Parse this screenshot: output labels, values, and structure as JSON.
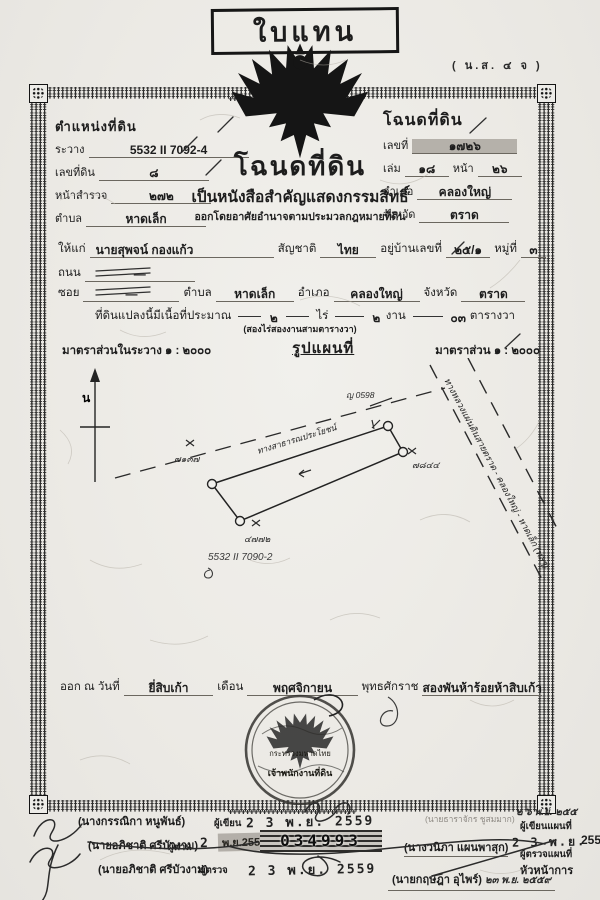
{
  "decor": {
    "motif": "‡"
  },
  "top": {
    "replacement": "ใบแทน",
    "form_code": "( น.ส. ๔ จ )"
  },
  "pos": {
    "title": "ตำแหน่งที่ดิน",
    "rawang_label": "ระวาง",
    "rawang": "5532 II 7092-4",
    "parcel_label": "เลขที่ดิน",
    "parcel": "๘",
    "survey_label": "หน้าสำรวจ",
    "survey": "๒๗๒",
    "tambon_label": "ตำบล",
    "tambon": "หาดเล็ก"
  },
  "deed": {
    "title": "โฉนดที่ดิน",
    "no_label": "เลขที่",
    "no": "๑๗๒๖",
    "book_label": "เล่ม",
    "book": "๑๘",
    "page_label": "หน้า",
    "page": "๒๖",
    "amphoe_label": "อำเภอ",
    "amphoe": "คลองใหญ่",
    "province_label": "จังหวัด",
    "province": "ตราด"
  },
  "title": {
    "main": "โฉนดที่ดิน",
    "sub": "เป็นหนังสือสำคัญแสดงกรรมสิทธิ์",
    "note": "ออกโดยอาศัยอำนาจตามประมวลกฎหมายที่ดิน"
  },
  "grantee": {
    "to_label": "ให้แก่",
    "name": "นายสุพจน์ กองแก้ว",
    "nationality_label": "สัญชาติ",
    "nationality": "ไทย",
    "address_label": "อยู่บ้านเลขที่",
    "address": "๒๕/๑",
    "moo_label": "หมู่ที่",
    "moo": "๓",
    "road_label": "ถนน",
    "road": "—",
    "soi_label": "ซอย",
    "soi": "—",
    "tambon_label": "ตำบล",
    "tambon": "หาดเล็ก",
    "amphoe_label": "อำเภอ",
    "amphoe": "คลองใหญ่",
    "province_label": "จังหวัด",
    "province": "ตราด"
  },
  "area": {
    "prefix": "ที่ดินแปลงนี้มีเนื้อที่ประมาณ",
    "rai": "๒",
    "rai_label": "ไร่",
    "ngan": "๒",
    "ngan_label": "งาน",
    "wa": "๐๓",
    "wa_label": "ตารางวา",
    "in_words": "(สองไร่สองงานสามตารางวา)"
  },
  "scale": {
    "left": "มาตราส่วนในระวาง ๑ : ๒๐๐๐",
    "map_title": "รูปแผนที่",
    "right": "มาตราส่วน ๑ : ๒๐๐๐"
  },
  "map": {
    "north": "น",
    "road_public": "ทางสาธารณประโยชน์",
    "highway": "ทางหลวงแผ่นดินสายตราด - คลองใหญ่ - หาดเล็ก (ทลๆ)",
    "marker_tl": "๗๑๓๗",
    "marker_top": "ญ 0598",
    "marker_r": "๗๘๔๔",
    "marker_b": "๔๗๗๒",
    "sheet_note": "5532 II 7090-2"
  },
  "issue": {
    "prefix": "ออก ณ วันที่",
    "day": "ยี่สิบเก้า",
    "month_label": "เดือน",
    "month": "พฤศจิกายน",
    "era_label": "พุทธศักราช",
    "year": "สองพันห้าร้อยห้าสิบเก้า"
  },
  "seal": {
    "line1": "กระทรวงมหาดไทย",
    "line2": "เจ้าพนักงานที่ดิน"
  },
  "bottom": {
    "left_rows": [
      {
        "name": "(นางกรรณิกา หนูพันธ์)",
        "role": "ผู้เขียน",
        "stamp": "2 3 พ.ย. 2559"
      },
      {
        "name": "(นายอภิชาติ ศรีบัวงาม)",
        "role": "ผู้ทาน",
        "stamp": "2 3",
        "stamp2": "พ.ย.2559"
      },
      {
        "name": "(นายอภิชาติ ศรีบัวงาม)",
        "role": "ผู้ตรวจ",
        "stamp": "2 3 พ.ย. 2559"
      }
    ],
    "serial": "034993",
    "right": {
      "clerk_name": "(นายธาราจักร ชูสมมาก)",
      "hand_date": "๒ ๖ พ.ย. ๒๕๕",
      "writer_label": "ผู้เขียนแผนที่",
      "stamp": "2 3 พ.ย.",
      "stamp_cut": "255",
      "checker_label": "ผู้ตรวจแผนที่",
      "checker_name": "(นางวนิภา แผนพาสุก)",
      "head_label": "หัวหน้าการ",
      "approver": "(นายกฤษฎา อุไพร์)",
      "approver_date": "๒๓ พ.ย. ๒๕๕๙"
    }
  }
}
